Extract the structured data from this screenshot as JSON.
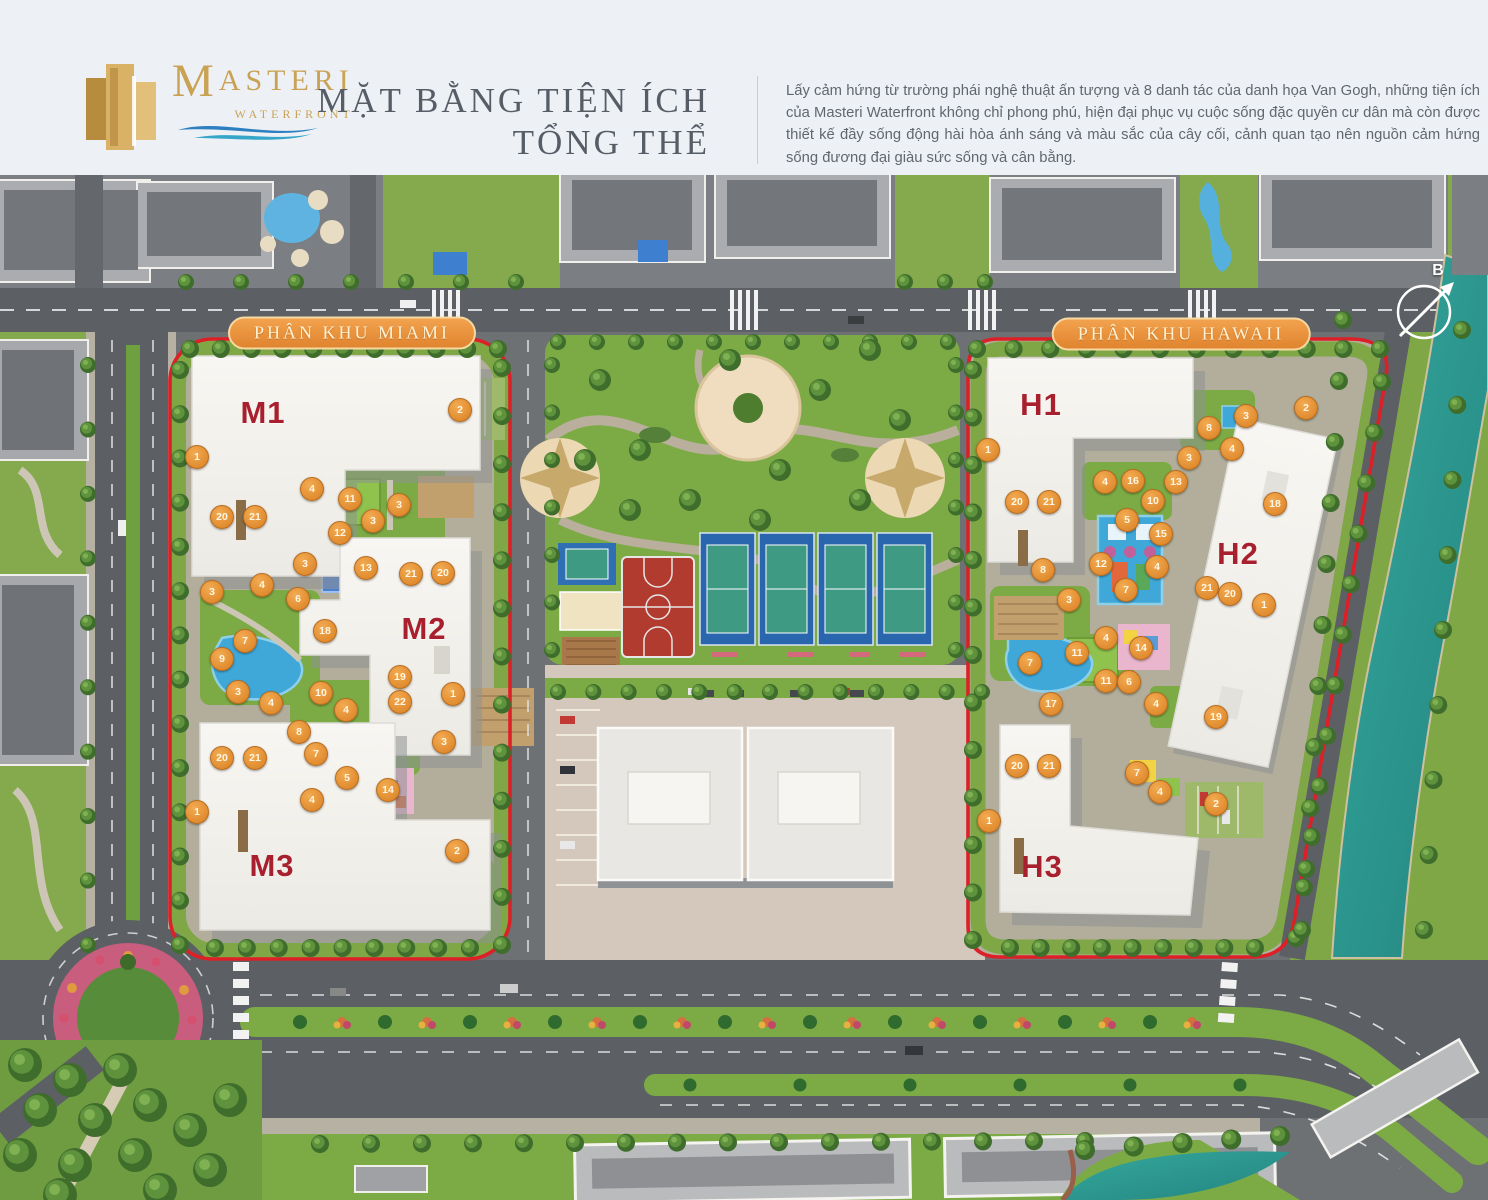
{
  "header": {
    "logo": {
      "brand_initial": "M",
      "brand_rest": "ASTERI",
      "sub": "WATERFRONT"
    },
    "title_line1": "MẶT BẰNG TIỆN ÍCH",
    "title_line2": "TỔNG THỂ",
    "description": "Lấy cảm hứng từ trường phái nghệ thuật ấn tượng và 8 danh tác của danh họa Van Gogh, những tiện ích của Masteri Waterfront không chỉ phong phú, hiện đại phục vụ cuộc sống đặc quyền cư dân mà còn được thiết kế đầy sống động hài hòa ánh sáng và màu sắc của cây cối, cảnh quan tạo nên nguồn cảm hứng sống đương đại giàu sức sống và cân bằng."
  },
  "map": {
    "zones": [
      {
        "id": "miami",
        "label": "PHÂN KHU MIAMI",
        "x": 352,
        "y": 333
      },
      {
        "id": "hawaii",
        "label": "PHÂN KHU HAWAII",
        "x": 1181,
        "y": 334
      }
    ],
    "buildings": [
      {
        "label": "M1",
        "x": 263,
        "y": 413
      },
      {
        "label": "M2",
        "x": 424,
        "y": 629
      },
      {
        "label": "M3",
        "x": 272,
        "y": 866
      },
      {
        "label": "H1",
        "x": 1041,
        "y": 405
      },
      {
        "label": "H2",
        "x": 1238,
        "y": 554
      },
      {
        "label": "H3",
        "x": 1042,
        "y": 867
      }
    ],
    "compass": {
      "label": "B",
      "x": 1438,
      "y": 271
    },
    "markers": [
      {
        "n": 1,
        "x": 197,
        "y": 457
      },
      {
        "n": 2,
        "x": 460,
        "y": 410
      },
      {
        "n": 4,
        "x": 312,
        "y": 489
      },
      {
        "n": 11,
        "x": 350,
        "y": 499
      },
      {
        "n": 3,
        "x": 399,
        "y": 505
      },
      {
        "n": 20,
        "x": 222,
        "y": 517
      },
      {
        "n": 21,
        "x": 255,
        "y": 517
      },
      {
        "n": 3,
        "x": 373,
        "y": 521
      },
      {
        "n": 12,
        "x": 340,
        "y": 533
      },
      {
        "n": 3,
        "x": 305,
        "y": 564
      },
      {
        "n": 13,
        "x": 366,
        "y": 568
      },
      {
        "n": 21,
        "x": 411,
        "y": 574
      },
      {
        "n": 20,
        "x": 443,
        "y": 573
      },
      {
        "n": 4,
        "x": 262,
        "y": 585
      },
      {
        "n": 3,
        "x": 212,
        "y": 592
      },
      {
        "n": 6,
        "x": 298,
        "y": 599
      },
      {
        "n": 18,
        "x": 325,
        "y": 631
      },
      {
        "n": 7,
        "x": 245,
        "y": 641
      },
      {
        "n": 9,
        "x": 222,
        "y": 659
      },
      {
        "n": 19,
        "x": 400,
        "y": 677
      },
      {
        "n": 3,
        "x": 238,
        "y": 692
      },
      {
        "n": 1,
        "x": 453,
        "y": 694
      },
      {
        "n": 4,
        "x": 271,
        "y": 703
      },
      {
        "n": 10,
        "x": 321,
        "y": 693
      },
      {
        "n": 22,
        "x": 400,
        "y": 702
      },
      {
        "n": 4,
        "x": 346,
        "y": 710
      },
      {
        "n": 8,
        "x": 299,
        "y": 732
      },
      {
        "n": 3,
        "x": 444,
        "y": 742
      },
      {
        "n": 7,
        "x": 316,
        "y": 754
      },
      {
        "n": 20,
        "x": 222,
        "y": 758
      },
      {
        "n": 21,
        "x": 255,
        "y": 758
      },
      {
        "n": 5,
        "x": 347,
        "y": 778
      },
      {
        "n": 14,
        "x": 388,
        "y": 790
      },
      {
        "n": 4,
        "x": 312,
        "y": 800
      },
      {
        "n": 1,
        "x": 197,
        "y": 812
      },
      {
        "n": 2,
        "x": 457,
        "y": 851
      },
      {
        "n": 1,
        "x": 988,
        "y": 450
      },
      {
        "n": 3,
        "x": 1246,
        "y": 416
      },
      {
        "n": 8,
        "x": 1209,
        "y": 428
      },
      {
        "n": 2,
        "x": 1306,
        "y": 408
      },
      {
        "n": 4,
        "x": 1232,
        "y": 449
      },
      {
        "n": 3,
        "x": 1189,
        "y": 458
      },
      {
        "n": 4,
        "x": 1105,
        "y": 482
      },
      {
        "n": 16,
        "x": 1133,
        "y": 481
      },
      {
        "n": 13,
        "x": 1176,
        "y": 482
      },
      {
        "n": 10,
        "x": 1153,
        "y": 501
      },
      {
        "n": 20,
        "x": 1017,
        "y": 502
      },
      {
        "n": 21,
        "x": 1049,
        "y": 502
      },
      {
        "n": 18,
        "x": 1275,
        "y": 504
      },
      {
        "n": 5,
        "x": 1127,
        "y": 520
      },
      {
        "n": 15,
        "x": 1161,
        "y": 534
      },
      {
        "n": 12,
        "x": 1101,
        "y": 564
      },
      {
        "n": 4,
        "x": 1157,
        "y": 567
      },
      {
        "n": 8,
        "x": 1043,
        "y": 570
      },
      {
        "n": 7,
        "x": 1126,
        "y": 590
      },
      {
        "n": 21,
        "x": 1207,
        "y": 588
      },
      {
        "n": 20,
        "x": 1230,
        "y": 594
      },
      {
        "n": 3,
        "x": 1069,
        "y": 600
      },
      {
        "n": 1,
        "x": 1264,
        "y": 605
      },
      {
        "n": 4,
        "x": 1106,
        "y": 638
      },
      {
        "n": 14,
        "x": 1141,
        "y": 648
      },
      {
        "n": 11,
        "x": 1077,
        "y": 653
      },
      {
        "n": 7,
        "x": 1030,
        "y": 663
      },
      {
        "n": 11,
        "x": 1106,
        "y": 681
      },
      {
        "n": 6,
        "x": 1129,
        "y": 682
      },
      {
        "n": 17,
        "x": 1051,
        "y": 704
      },
      {
        "n": 4,
        "x": 1156,
        "y": 704
      },
      {
        "n": 19,
        "x": 1216,
        "y": 717
      },
      {
        "n": 20,
        "x": 1017,
        "y": 766
      },
      {
        "n": 21,
        "x": 1049,
        "y": 766
      },
      {
        "n": 7,
        "x": 1137,
        "y": 773
      },
      {
        "n": 4,
        "x": 1160,
        "y": 792
      },
      {
        "n": 2,
        "x": 1216,
        "y": 804
      },
      {
        "n": 1,
        "x": 989,
        "y": 821
      }
    ],
    "colors": {
      "boundary": "#dd2027",
      "marker": "#e08a2e",
      "zone_pill": "#e8923c",
      "building_label": "#a81f2d",
      "grass": "#7dab48",
      "water_canal": "#2f9c94",
      "water_pool": "#45a9d9",
      "asphalt": "#5c6064"
    }
  }
}
